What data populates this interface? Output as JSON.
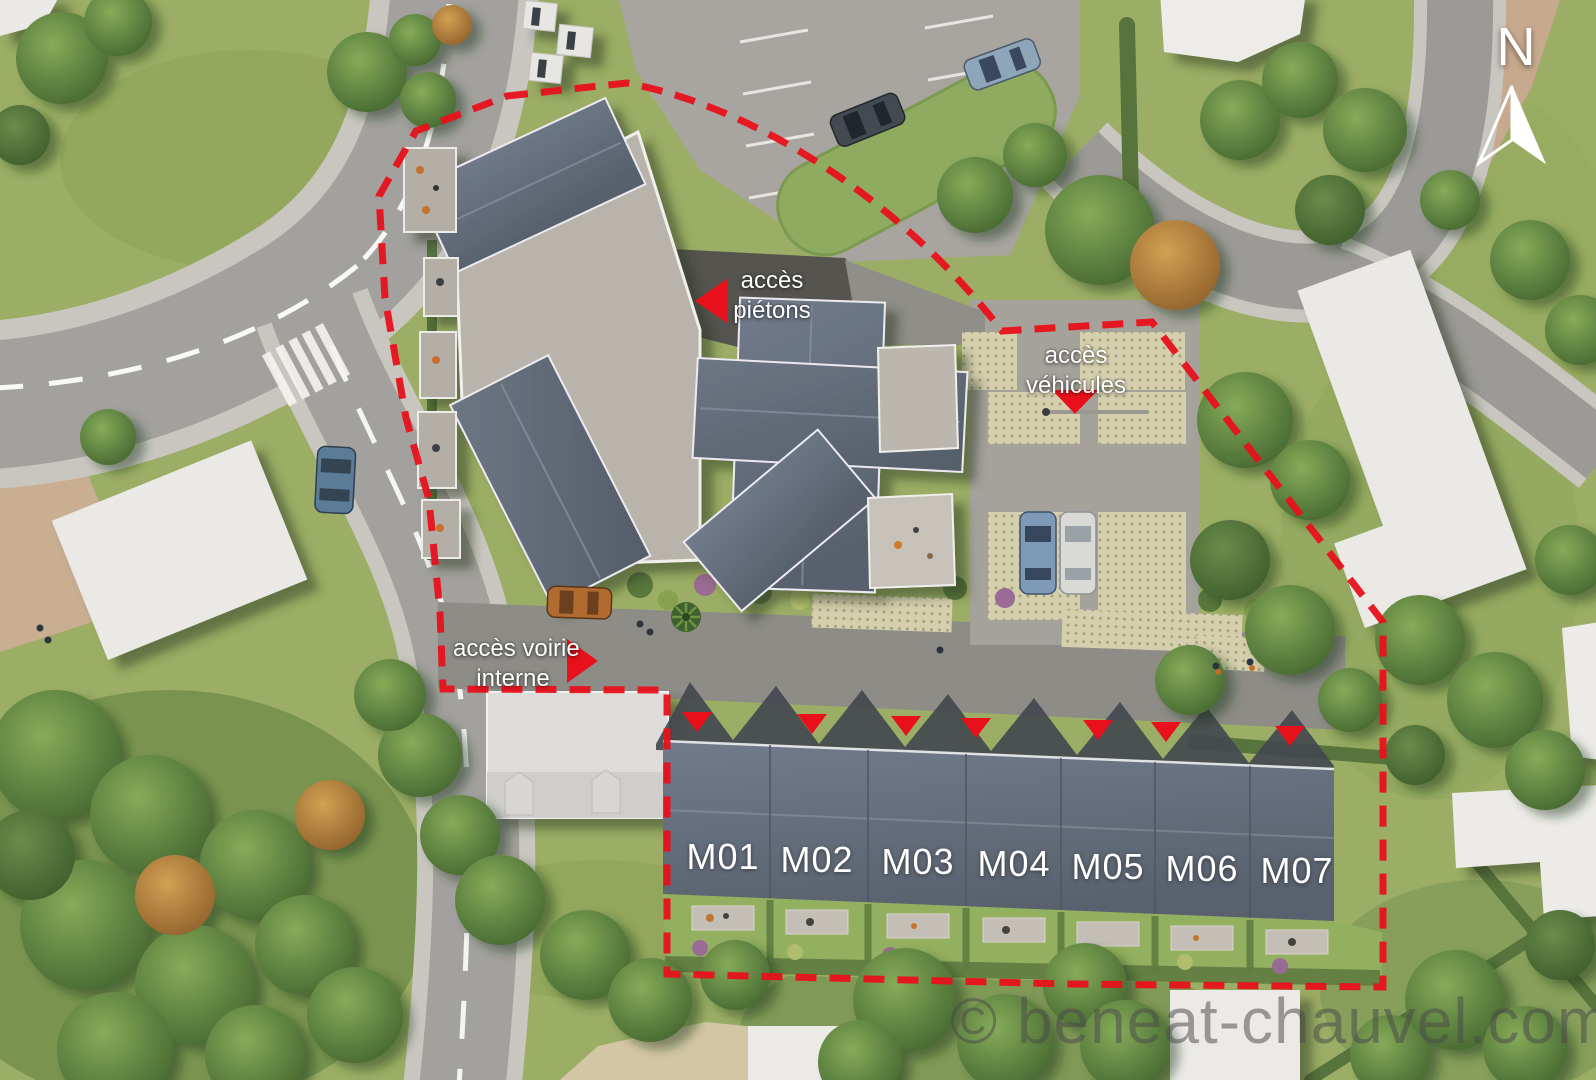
{
  "plan": {
    "compass_label": "N",
    "access": {
      "pedestrian": {
        "line1": "accès",
        "line2": "piétons"
      },
      "vehicles": {
        "line1": "accès",
        "line2": "véhicules"
      },
      "internal_road": {
        "line1": "accès voirie",
        "line2": "interne"
      }
    },
    "units": {
      "labels": [
        "M01",
        "M02",
        "M03",
        "M04",
        "M05",
        "M06",
        "M07"
      ]
    },
    "watermark": "© beneat-chauvel.com",
    "icons": {
      "north_arrow": "compass-needle",
      "pedestrian_access_arrow": "triangle-left",
      "vehicle_access_arrow": "triangle-down",
      "internal_road_access_arrow": "triangle-right",
      "unit_entry_marker": "triangle-down"
    },
    "colors": {
      "boundary_red": "#e8111b",
      "label_white": "#ffffff",
      "slate_roof": "#66707f",
      "flat_roof": "#b9b4ab",
      "neighbor_building_white": "#ebe9e5",
      "road_gray": "#a3a19d",
      "internal_road_gray": "#8e8c87",
      "grass_green": "#9cae65",
      "tree_green": "#5d8140",
      "watermark_gray": "#4a4a4a"
    }
  }
}
